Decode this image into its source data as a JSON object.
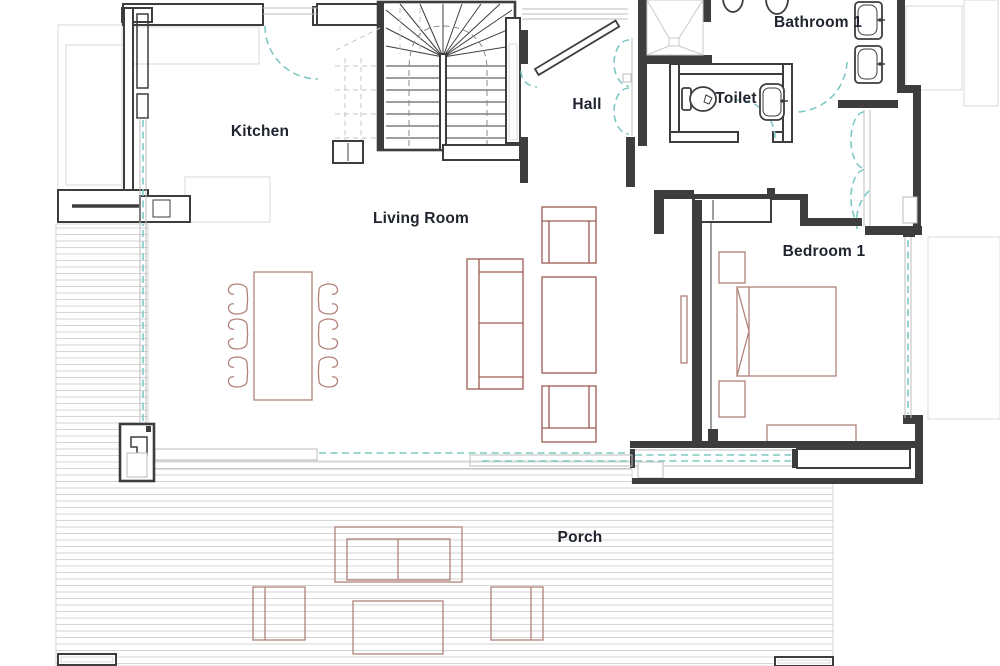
{
  "title": "Apartment floor plan — ground floor",
  "labels": {
    "kitchen": "Kitchen",
    "hall": "Hall",
    "bathroom1": "Bathroom 1",
    "toilet": "Toilet",
    "living_room": "Living Room",
    "bedroom1": "Bedroom 1",
    "porch": "Porch"
  },
  "colors": {
    "wall": "#3d3d3d",
    "furniture": "#b08379",
    "furniture_dark": "#9e5a52",
    "glazing": "#7fc9c4",
    "deck_line": "#d4d4d4",
    "counter_line": "#d9d9d9",
    "label_text": "#20242e",
    "background": "#ffffff"
  },
  "fixtures": [
    "staircase",
    "entrance-door",
    "shower",
    "toilet",
    "washbasin",
    "double-washbasin",
    "dining-table",
    "dining-chair",
    "sofa",
    "armchair",
    "coffee-table",
    "tv",
    "fireplace",
    "double-bed",
    "nightstand",
    "wardrobe",
    "dresser",
    "sliding-glass-door",
    "window",
    "outdoor-sofa",
    "outdoor-armchair",
    "outdoor-table",
    "deck-steps",
    "porch-deck"
  ]
}
